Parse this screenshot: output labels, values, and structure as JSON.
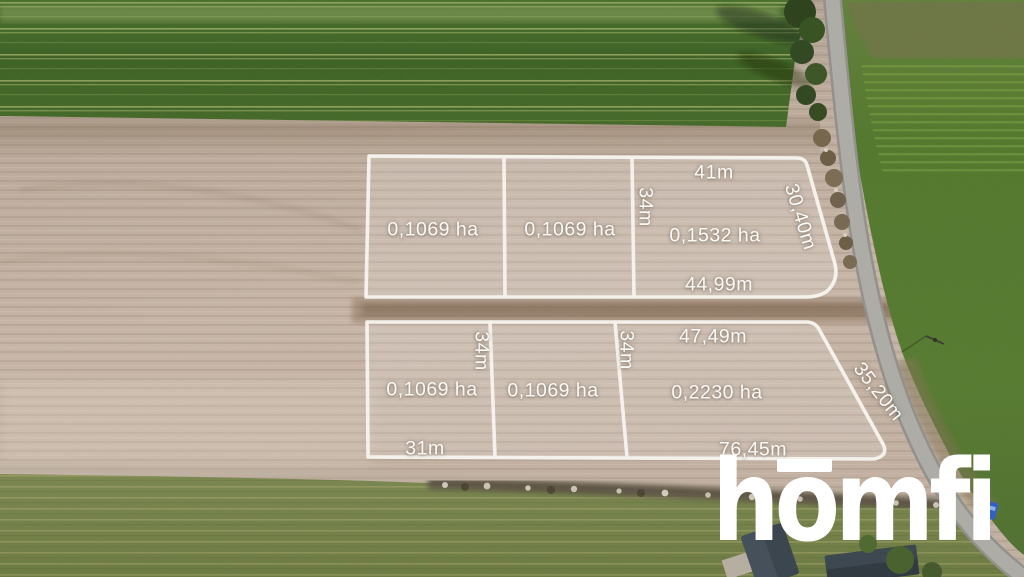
{
  "watermark": {
    "logo_text": "homfi",
    "color": "#ffffff"
  },
  "overlay": {
    "line_color": "#f8f6f1",
    "fill_color": "rgba(255,255,255,0.16)",
    "labels": {
      "plot1_area": "0,1069 ha",
      "plot2_area": "0,1069 ha",
      "plot3_area": "0,1532 ha",
      "plot3_top": "41m",
      "plot3_left": "34m",
      "plot3_right": "30,40m",
      "plot3_bottom": "44,99m",
      "plot4_area": "0,1069 ha",
      "plot4_right": "34m",
      "plot4_bottom": "31m",
      "plot5_area": "0,1069 ha",
      "plot6_area": "0,2230 ha",
      "plot6_top": "47,49m",
      "plot6_left": "34m",
      "plot6_right": "35,20m",
      "plot6_bottom": "76,45m"
    }
  },
  "scene": {
    "colors": {
      "crop_field_green": "#3f6426",
      "plowed_field_tan": "#c2b1a2",
      "meadow_green": "#73824a",
      "roadside_green": "#567b30",
      "road_gray": "#a8a7a2",
      "house_roof": "#37424c",
      "car_blue": "#2b5fc7",
      "overlay_white": "#f8f6f1"
    }
  }
}
